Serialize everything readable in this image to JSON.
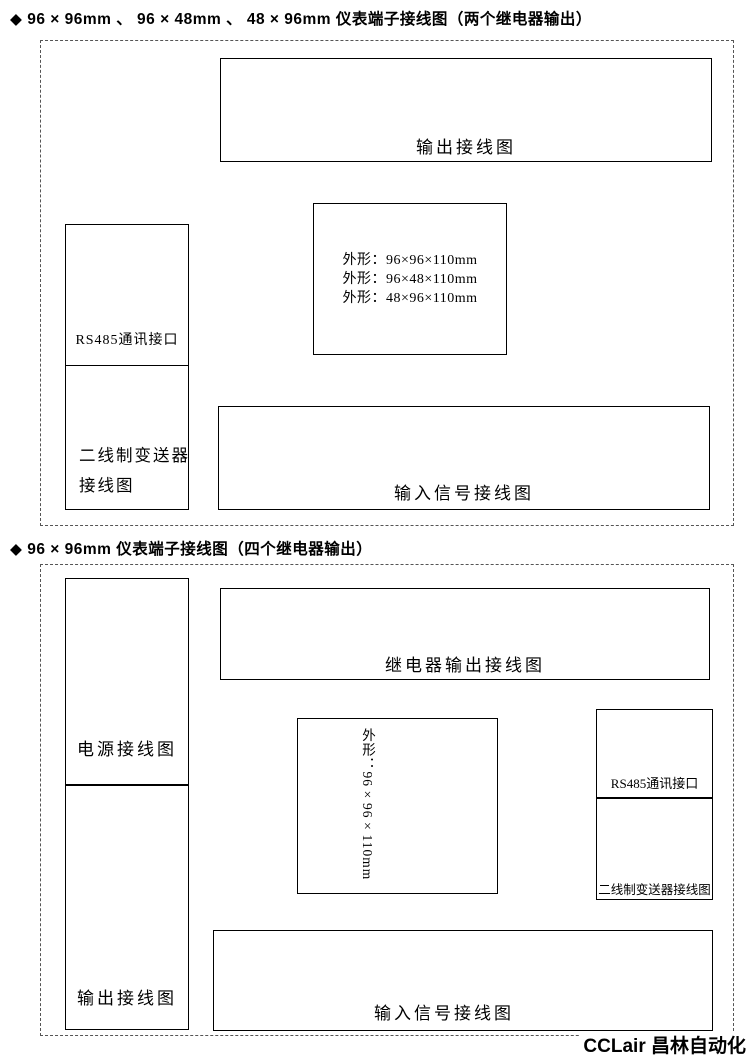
{
  "titles": {
    "section1": "◆ 96 × 96mm 、 96 × 48mm 、 48 × 96mm 仪表端子接线图（两个继电器输出）",
    "section2": "◆ 96 × 96mm 仪表端子接线图（四个继电器输出）"
  },
  "watermark": "CCLair 昌林自动化",
  "s1": {
    "power": {
      "label": "电源接线图",
      "items": [
        {
          "name": "AC90~265V",
          "signs": [
            "",
            ""
          ],
          "terminals": [
            "15",
            "16"
          ]
        },
        {
          "name": "DC24V",
          "signs": [
            "+",
            "−"
          ],
          "terminals": [
            "15",
            "16"
          ]
        }
      ]
    },
    "rs485": {
      "label": "RS485通讯接口",
      "line1": "T/R (B)",
      "line2": "T/R (A)",
      "terminals": [
        "13",
        "14"
      ]
    },
    "transmitter": {
      "label_line1": "二线制变送器",
      "label_line2": "接线图",
      "box": [
        "二线",
        "制变",
        "送器"
      ],
      "signs": [
        "−",
        "+"
      ],
      "terminals": [
        "3",
        "6"
      ]
    },
    "output": {
      "label": "输出接线图",
      "relays": [
        {
          "tag": "AH",
          "caption": "第一报警",
          "on": "ON",
          "terminals": [
            "9",
            "10"
          ]
        },
        {
          "tag": "AL",
          "caption": "第二报警",
          "on": "ON",
          "terminals": [
            "11",
            "12"
          ]
        }
      ],
      "feeds": [
        {
          "caption": "馈电输出",
          "name": "DC24V",
          "signs": [
            "−",
            "+"
          ],
          "terminals": [
            "2",
            "6"
          ]
        },
        {
          "caption": "变送输出",
          "name": "mA/V",
          "signs": [
            "−",
            "+"
          ],
          "terminals": [
            "7",
            "8"
          ]
        }
      ]
    },
    "center": {
      "top": [
        "1",
        "2",
        "3",
        "4",
        "5",
        "6",
        "7",
        "8"
      ],
      "bottom": [
        "9",
        "10",
        "11",
        "12",
        "13",
        "14",
        "15",
        "16"
      ],
      "dims": [
        "外形：96×96×110mm",
        "外形：96×48×110mm",
        "外形：48×96×110mm"
      ]
    },
    "input": {
      "label": "输入信号接线图",
      "groups": [
        {
          "name": "mV/TC热电偶",
          "type": "tc",
          "signs": [
            "−",
            "+"
          ],
          "terminals": [
            "2",
            "3"
          ]
        },
        {
          "name": "V电压",
          "type": "plain",
          "signs": [
            "−",
            "+"
          ],
          "terminals": [
            "2",
            "5"
          ]
        },
        {
          "name": "mA电流",
          "type": "plain",
          "signs": [
            "−",
            "+"
          ],
          "terminals": [
            "2",
            "3"
          ]
        },
        {
          "name": "f频率",
          "type": "plain",
          "signs": [
            "−",
            "+"
          ],
          "terminals": [
            "5",
            "6"
          ]
        },
        {
          "name": "RTD热电阻",
          "type": "rtd",
          "terminals": [
            "2",
            "3",
            "4"
          ]
        },
        {
          "name": "远传压力电阻",
          "type": "res",
          "terminals": [
            "2",
            "3",
            "4"
          ]
        }
      ]
    }
  },
  "s2": {
    "power": {
      "label": "电源接线图",
      "items": [
        {
          "name": "AC90~265V",
          "signs": [
            "",
            ""
          ],
          "terminals": [
            "15",
            "16"
          ]
        },
        {
          "name": "DC24V",
          "signs": [
            "+",
            "−"
          ],
          "terminals": [
            "15",
            "16"
          ]
        }
      ]
    },
    "outputs": {
      "label": "输出接线图",
      "feeds": [
        {
          "caption": "变送输出",
          "name": "mA/V",
          "signs": [
            "−",
            "+"
          ],
          "terminals": [
            "21",
            "22"
          ]
        },
        {
          "caption": "馈电输出",
          "name": "DC24V",
          "signs": [
            "−",
            "+"
          ],
          "terminals": [
            "1",
            "23"
          ]
        }
      ]
    },
    "relay": {
      "label": "继电器输出接线图",
      "relays": [
        {
          "tag": "AH",
          "caption": "第一报警",
          "on": "ON",
          "terminals": [
            "9",
            "10"
          ]
        },
        {
          "tag": "AL",
          "caption": "第二报警",
          "on": "ON",
          "terminals": [
            "11",
            "12"
          ]
        },
        {
          "tag": "AHH",
          "caption": "第三报警",
          "on": "ON",
          "terminals": [
            "17",
            "18"
          ]
        },
        {
          "tag": "ALL",
          "caption": "第四报警",
          "on": "ON",
          "terminals": [
            "19",
            "20"
          ]
        }
      ]
    },
    "center": {
      "left": [
        "1",
        "2",
        "3",
        "4",
        "5",
        "6",
        "7",
        "8"
      ],
      "mid": [
        "17",
        "18",
        "19",
        "20",
        "21",
        "22",
        "23",
        "24"
      ],
      "right": [
        "9",
        "10",
        "11",
        "12",
        "13",
        "14",
        "15",
        "16"
      ],
      "dims": "外形：96×96×110mm"
    },
    "rs485": {
      "label": "RS485通讯接口",
      "line1": "T/R (B)",
      "line2": "T/R (A)",
      "terminals": [
        "13",
        "14"
      ]
    },
    "transmitter": {
      "label": "二线制变送器接线图",
      "box": [
        "二线",
        "制变",
        "送器"
      ],
      "signs": [
        "−",
        "+"
      ],
      "terminals": [
        "6",
        "23"
      ]
    },
    "input": {
      "label": "输入信号接线图",
      "groups": [
        {
          "name": "mV/TC热电偶",
          "type": "tc",
          "signs": [
            "−",
            "+"
          ],
          "terminals": [
            "1",
            "2"
          ]
        },
        {
          "name": "V电压",
          "type": "plain",
          "signs": [
            "−",
            "+"
          ],
          "terminals": [
            "1",
            "4"
          ]
        },
        {
          "name": "mA电流",
          "type": "plain",
          "signs": [
            "−",
            "+"
          ],
          "terminals": [
            "5",
            "6"
          ]
        },
        {
          "name": "RTD热电阻",
          "type": "rtd",
          "terminals": [
            "5",
            "6",
            "7"
          ]
        },
        {
          "name": "远传压力电阻",
          "type": "res",
          "terminals": [
            "5",
            "6",
            "7"
          ]
        }
      ]
    }
  }
}
